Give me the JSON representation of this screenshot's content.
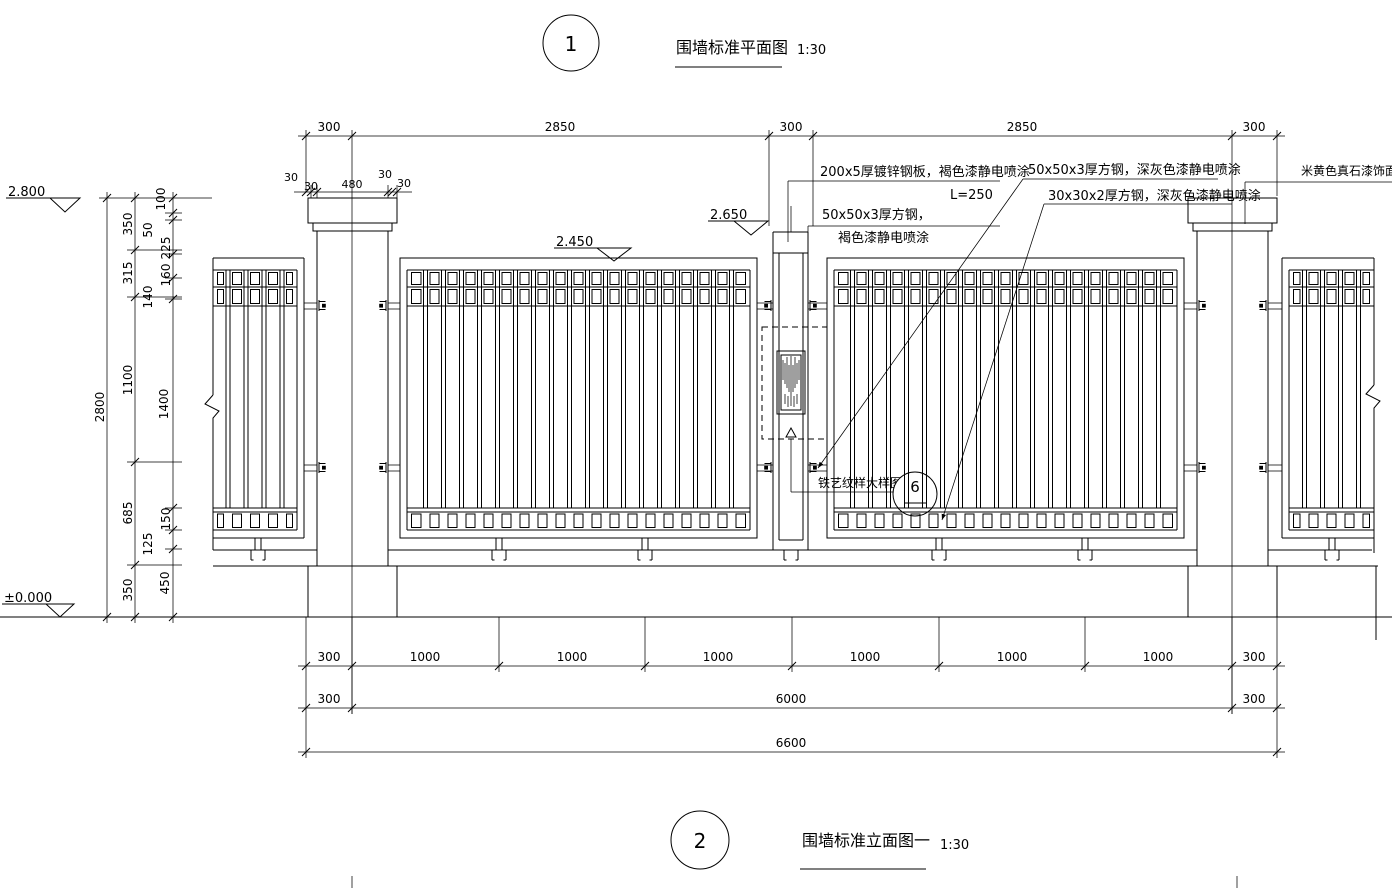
{
  "titles": {
    "plan": {
      "number": "1",
      "label": "围墙标准平面图",
      "scale": "1:30"
    },
    "elevation": {
      "number": "2",
      "label": "围墙标准立面图一",
      "scale": "1:30"
    }
  },
  "elevations": {
    "wall_top": "2.800",
    "post_top": "2.650",
    "panel_top": "2.450",
    "ground": "±0.000"
  },
  "annotations": {
    "steel_plate": "200x5厚镀锌钢板，褐色漆静电喷涂",
    "steel_plate_length": "L=250",
    "square_steel_brown_line1": "50x50x3厚方钢，",
    "square_steel_brown_line2": "褐色漆静电喷涂",
    "square_steel_gray_50": "50x50x3厚方钢，深灰色漆静电喷涂",
    "square_steel_gray_30": "30x30x2厚方钢，深灰色漆静电喷涂",
    "stone_finish": "米黄色真石漆饰面",
    "iron_pattern_detail": "铁艺纹样大样图",
    "detail_bubble_number": "6"
  },
  "dimensions": {
    "top": [
      "300",
      "2850",
      "300",
      "2850",
      "300"
    ],
    "cap": [
      "30",
      "30",
      "480",
      "30",
      "30"
    ],
    "bottom_row1": [
      "300",
      "1000",
      "1000",
      "1000",
      "1000",
      "1000",
      "1000",
      "300"
    ],
    "bottom_row2": [
      "300",
      "6000",
      "300"
    ],
    "bottom_row3": [
      "6600"
    ],
    "left_outer": [
      "2800"
    ],
    "left_middle": [
      "350",
      "315",
      "1100",
      "685",
      "350"
    ],
    "left_inner": [
      "100",
      "50",
      "225",
      "160",
      "140",
      "1400",
      "150",
      "125",
      "450"
    ]
  },
  "colors": {
    "line": "#000000",
    "background": "#ffffff"
  }
}
